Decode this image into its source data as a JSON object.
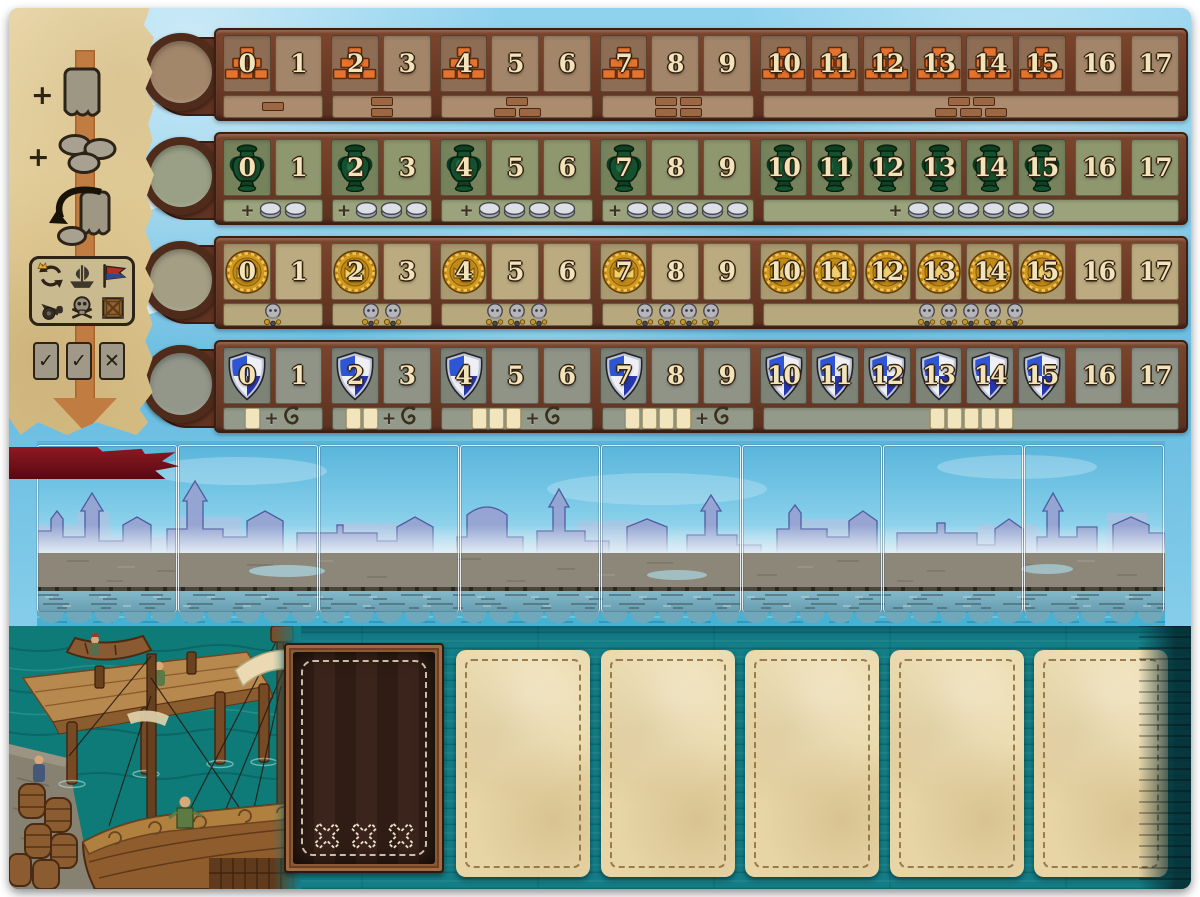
{
  "cell_labels": [
    "0",
    "1",
    "2",
    "3",
    "4",
    "5",
    "6",
    "7",
    "8",
    "9",
    "10",
    "11",
    "12",
    "13",
    "14",
    "15",
    "16",
    "17"
  ],
  "tracks": [
    {
      "id": "brick-track",
      "marker": "brick-pyramid",
      "marker_color": "#e6732d",
      "icon_cells": [
        0,
        2,
        4,
        7,
        10,
        11,
        12,
        13,
        14,
        15
      ],
      "rewards": [
        {
          "type": "brick",
          "count": 1
        },
        {
          "type": "brick",
          "count": 2
        },
        {
          "type": "brick",
          "count": 3
        },
        {
          "type": "brick",
          "count": 4
        },
        {
          "type": "brick",
          "count": 5
        }
      ]
    },
    {
      "id": "amphora-track",
      "marker": "amphora",
      "marker_color": "#14522f",
      "icon_cells": [
        0,
        2,
        4,
        7,
        10,
        11,
        12,
        13,
        14,
        15
      ],
      "rewards": [
        {
          "type": "coin",
          "count": 2,
          "plus": "+"
        },
        {
          "type": "coin",
          "count": 3,
          "plus": "+"
        },
        {
          "type": "coin",
          "count": 4,
          "plus": "+"
        },
        {
          "type": "coin",
          "count": 5,
          "plus": "+"
        },
        {
          "type": "coin",
          "count": 6,
          "plus": "+"
        }
      ]
    },
    {
      "id": "medal-track",
      "marker": "gold-medal",
      "marker_color": "#cf9a1f",
      "icon_cells": [
        0,
        2,
        4,
        7,
        10,
        11,
        12,
        13,
        14,
        15
      ],
      "rewards": [
        {
          "type": "skull",
          "count": 1
        },
        {
          "type": "skull",
          "count": 2
        },
        {
          "type": "skull",
          "count": 3
        },
        {
          "type": "skull",
          "count": 4
        },
        {
          "type": "skull",
          "count": 5
        }
      ]
    },
    {
      "id": "shield-track",
      "marker": "shield",
      "marker_color": "#2f55cf",
      "icon_cells": [
        0,
        2,
        4,
        7,
        10,
        11,
        12,
        13,
        14,
        15
      ],
      "rewards": [
        {
          "type": "card",
          "count": 1,
          "plus": "+",
          "hook": true
        },
        {
          "type": "card",
          "count": 2,
          "plus": "+",
          "hook": true
        },
        {
          "type": "card",
          "count": 3,
          "plus": "+",
          "hook": true
        },
        {
          "type": "card",
          "count": 4,
          "plus": "+",
          "hook": true
        },
        {
          "type": "card",
          "count": 5
        }
      ]
    }
  ],
  "sidebar": {
    "gain_card_plus": "+",
    "gain_coins_plus": "+",
    "suit_icons": [
      "cycle-crown",
      "ship",
      "flag",
      "cannon",
      "skull",
      "crate"
    ],
    "validity_symbols": [
      "✓",
      "✓",
      "✕"
    ]
  },
  "harbor": {
    "slot_count": 8,
    "banner_color": "#7e1118"
  },
  "bottom": {
    "card_slot_count": 5,
    "discard_stitch_count": 3
  },
  "colors": {
    "sky": "#7ac6e6",
    "wood_frame": "#6b3a24",
    "teal_planks": "#137e87",
    "parchment": "#e9d7a5",
    "brick_orange": "#e6732d",
    "amphora_green": "#14522f",
    "medal_gold": "#cf9a1f",
    "shield_blue": "#2f55cf",
    "banner_red": "#7e1118"
  }
}
